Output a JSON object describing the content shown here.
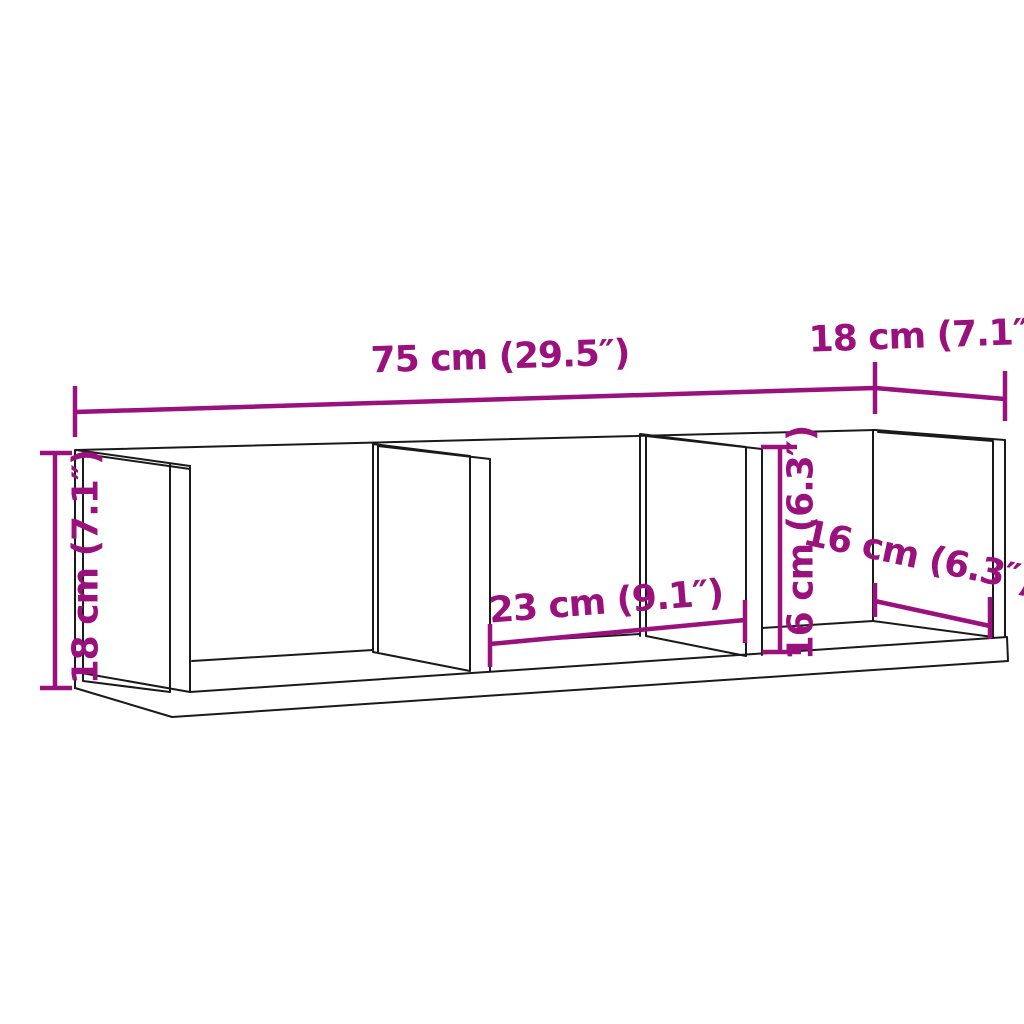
{
  "diagram": {
    "subject": "wall-shelf-with-3-compartments",
    "colors": {
      "dimension_accent": "#9a107c",
      "outline": "#1a1a1a",
      "background": "#ffffff"
    },
    "labels": {
      "overall_width": "75 cm (29.5″)",
      "overall_depth": "18 cm (7.1″)",
      "overall_height": "18 cm (7.1″)",
      "compartment_width": "23 cm (9.1″)",
      "compartment_height": "16 cm (6.3″)",
      "compartment_depth": "16 cm (6.3″)"
    }
  }
}
